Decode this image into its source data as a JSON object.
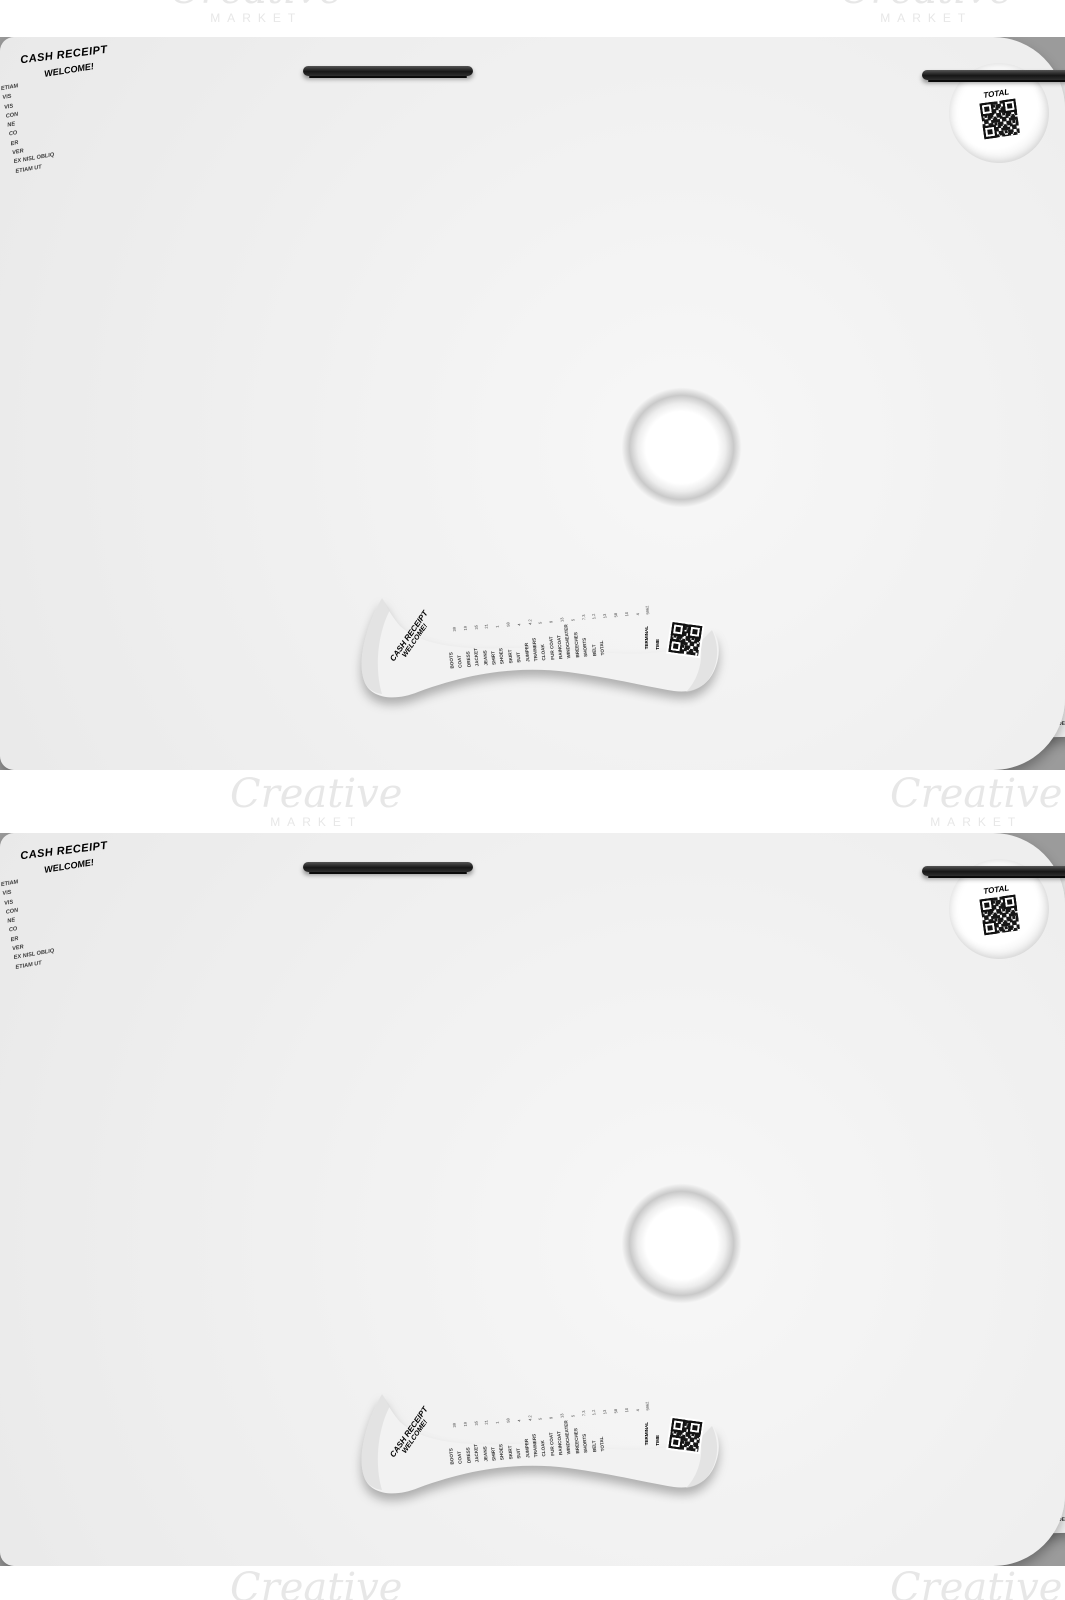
{
  "watermark": {
    "script": "Creative",
    "caps": "MARKET"
  },
  "main_town": {
    "title": "MAIN TOWN STORE 1.2",
    "addr1": "LOREM IPSUM DOLOR SIT AMET",
    "addr2": "545 66-54 00000 1-XXX-00XXX48",
    "date": "Monday 11/10/2024",
    "time": "09:45 PM",
    "merchant": "Merchant ID: John Doe 544z5 g",
    "items": [
      {
        "l": "Etiam utinam",
        "v": "$ 4.5"
      },
      {
        "l": "Vis ex",
        "v": "$ 7.2"
      },
      {
        "l": "Vis decore",
        "v": "$ 17"
      },
      {
        "l": "Consequuntur",
        "v": "$ 4.5"
      },
      {
        "l": "Ne mel natum",
        "v": "$ 6.5"
      },
      {
        "l": "Consul, eam",
        "v": "$ 11.2"
      },
      {
        "l": "Error alterum",
        "v": "$ 47"
      },
      {
        "l": "Verterem",
        "v": "$ 1.21"
      },
      {
        "l": "Ex nisl oblique",
        "v": "$ 9.7"
      }
    ],
    "subtotal_l": "SUB TOTAL",
    "subtotal_v": "$ 107.01",
    "transaction": "Transaction: 15XX2-4501",
    "footer": "WELCOME!"
  },
  "lorem_office": {
    "title": "LOREM OFFICE #4",
    "subtitle": "RECEIPT #46-7F",
    "addr1": "126 Road-Vida posidonium incorrupte",
    "addr2": "Promo Discount #165 S/T/C 48",
    "items": [
      {
        "l": "Lorem voluptua",
        "v": "$ 8"
      },
      {
        "l": "Nostro",
        "v": "$ 6"
      },
      {
        "l": "Cu ius altera",
        "v": "$ 7.1"
      },
      {
        "l": "Soluta laoreet",
        "v": "$ 5.2"
      },
      {
        "l": "Ea prompta",
        "v": "$ 2"
      },
      {
        "l": "Ei has congue",
        "v": "$ 2.1"
      },
      {
        "l": "Corrumpit",
        "v": "$ 4.2"
      },
      {
        "l": "Verterem",
        "v": "$ 7.5"
      },
      {
        "l": "Accusam gloriatur",
        "v": "$ 4.8"
      },
      {
        "l": "Modus insolens",
        "v": "$ 1"
      },
      {
        "l": "Antiopam indoctum",
        "v": "$ 1.1"
      },
      {
        "l": "Nostro",
        "v": "$ 9.2"
      },
      {
        "l": "Causae quaestio",
        "v": "$ 7.2"
      },
      {
        "l": "Aeterno perfecto",
        "v": "$ 4"
      },
      {
        "l": "Accommodare",
        "v": "$ 4"
      },
      {
        "l": "Abore phaedrum",
        "v": "$ 1.2"
      },
      {
        "l": "Dard malestatis",
        "v": "$ 8.1"
      },
      {
        "l": "Est dicam",
        "v": "$ 1"
      },
      {
        "l": "Utent imperdiet",
        "v": "$ 3"
      },
      {
        "l": "Deserunt nam",
        "v": "$ 1.1"
      },
      {
        "l": "Detracto",
        "v": "$ 7.2"
      }
    ],
    "pay_l": "You PAY",
    "pay_v": "$ 95",
    "terminal": "TERMINAL# 04",
    "date": "12.11.2022 13:01",
    "code": "XXX-X46"
  },
  "your_shop": {
    "title": "YOUR SHOP HERE",
    "addr": "FLOWER ST 45F LOREM CITY, 31431484 08067",
    "terminal": "TERMINAL A/7",
    "time": "8:40 PM",
    "items": [
      {
        "l": "Beer",
        "v": "$ 24"
      },
      {
        "l": "Vine",
        "v": "$ 75"
      },
      {
        "l": "Chicken meat",
        "v": "$ 23"
      },
      {
        "l": "Salmon",
        "v": "$ 5"
      },
      {
        "l": "Broccoli",
        "v": "$ 11"
      },
      {
        "l": "Leek",
        "v": "$ 5"
      },
      {
        "l": "Cranberry",
        "v": "$ 12"
      },
      {
        "l": "Cottage cheese",
        "v": "$ 23"
      },
      {
        "l": "Caramel",
        "v": "$ 8"
      },
      {
        "l": "Pumpkin pie",
        "v": "$ 13"
      }
    ],
    "subtotal_l": "SUB TOTAL",
    "subtotal_v": "$ 199",
    "footer": "THANK YOU FOR COMING!"
  },
  "d12": {
    "title": "RECEIPT",
    "number": "D#12",
    "order": "ORDER#43/5",
    "time": "23:11",
    "date": "TUE 31.10.2025",
    "manager": "MANAGER JANE DOE  #1012",
    "items": [
      {
        "l": "CLAW HAMMER",
        "v": "4.15"
      },
      {
        "l": "FLATHEAD SCREWDRIVER",
        "v": "7.2"
      },
      {
        "l": "PHILLIPS SCREWDRIVER",
        "v": "1.23"
      },
      {
        "l": "CRESCENT WRENCH",
        "v": "4.2"
      }
    ],
    "total_l": "YOUR TOTAL",
    "total_v": "16.78",
    "footer": "THANK YOU FOR VIZITING!"
  },
  "brand_shop": {
    "title": "BRAND SHOP",
    "subtitle": "CASH RECEIPT #181101",
    "cashier": "Cashier: 1X01 Card: 01***1X",
    "items": [
      {
        "l": "T-shirt",
        "v": "2.5"
      },
      {
        "l": "Waistcoat",
        "v": "1.4"
      },
      {
        "l": "Hoodie",
        "v": "5.4"
      },
      {
        "l": "Breeches",
        "v": "5.6"
      },
      {
        "l": "Sweat pants",
        "v": "8.7"
      },
      {
        "l": "Dress shirt",
        "v": "1.2"
      },
      {
        "l": "Dressing gown",
        "v": "7.1"
      },
      {
        "l": "Wrap dress",
        "v": "9.8"
      },
      {
        "l": "Slip dress",
        "v": "5.1"
      }
    ],
    "subtotal_l": "SUBTOTAL",
    "subtotal_v": "$46.8",
    "total_l": "TOTAL",
    "total_v": "$46.8",
    "footer": "THANK YOU FOR COMING!",
    "note": "Lorem ipsum dolor sit amet sed ut fugit solet anima"
  },
  "store_long": {
    "welcome": "WELCOME TO OUR STORE",
    "title": "RECEIPT",
    "addr": "Lorem ipsum dolor street X City",
    "merchant": "MERCHANT: JANE DOE 483#41",
    "items": [
      {
        "l": "INANI",
        "v": "45"
      },
      {
        "l": "LABORE",
        "v": "31"
      },
      {
        "l": "EAM ALIA",
        "v": "1"
      },
      {
        "l": "EA PROMPTA",
        "v": "21.1"
      },
      {
        "l": "NO VEL",
        "v": "5.5"
      },
      {
        "l": "ALIQUIP",
        "v": "4.1"
      },
      {
        "l": "APERIRI",
        "v": "5"
      },
      {
        "l": "SENSERIT ET",
        "v": "8"
      },
      {
        "l": "SOLUTA",
        "v": "11"
      },
      {
        "l": "LAOREET",
        "v": "8"
      },
      {
        "l": "DEFINIEBAS",
        "v": "12"
      },
      {
        "l": "IQ HIS",
        "v": "10.1"
      },
      {
        "l": "TE DUO DUEM",
        "v": "48"
      },
      {
        "l": "DELICATISSIMI",
        "v": "3.8"
      },
      {
        "l": "EA PROMPTA",
        "v": "1.8"
      },
      {
        "l": "DESERUNT EST",
        "v": "7.5"
      },
      {
        "l": "DICAM PROMPTA",
        "v": "2.2"
      },
      {
        "l": "OMITTANTUR AD VI",
        "v": "6.7"
      },
      {
        "l": "NO SEA EST",
        "v": "8"
      },
      {
        "l": "MAIESTATIS",
        "v": "7"
      },
      {
        "l": "INIMICUS NO HAS",
        "v": "4.8"
      },
      {
        "l": "QUI EX CAUSAE",
        "v": "9"
      },
      {
        "l": "QUAESTIO",
        "v": "1.5"
      },
      {
        "l": "SCRIPSERIT",
        "v": "6.2"
      },
      {
        "l": "DOMINO",
        "v": "1.7"
      },
      {
        "l": "IN VIRIS DENIQUE",
        "v": "7.1"
      },
      {
        "l": "PROBATUS HIS",
        "v": "8"
      },
      {
        "l": "DUO SIMUL ACCUSAM",
        "v": "11"
      },
      {
        "l": "SIT AN PRIMI",
        "v": "8"
      },
      {
        "l": "PERICULIS",
        "v": "7.12"
      },
      {
        "l": "PRI IUDICO PRAESEN",
        "v": "3.1"
      },
      {
        "l": "EX FERRI VIVENDUM",
        "v": "7.8"
      },
      {
        "l": "DEMOCRITUM UT PER",
        "v": "1.6"
      },
      {
        "l": "LOREM",
        "v": "5"
      },
      {
        "l": "LUPTUA",
        "v": "7.7"
      },
      {
        "l": "ADOLESCENS HAS",
        "v": "8.5"
      },
      {
        "l": "NE UT MEI DICTA",
        "v": "4.2"
      },
      {
        "l": "DEMOCRITUM",
        "v": "11"
      },
      {
        "l": "AD HAS FACILISI",
        "v": "5"
      },
      {
        "l": "ADIPISCI",
        "v": "8"
      },
      {
        "l": "PERSIUS AN",
        "v": "8.5"
      },
      {
        "l": "QUI VIDE",
        "v": "1.23"
      },
      {
        "l": "POSIDONIUM",
        "v": "10"
      },
      {
        "l": "INCORRUPTE",
        "v": "3.8"
      },
      {
        "l": "CUM TE",
        "v": "5.3"
      },
      {
        "l": "SCRIBENTUR",
        "v": "2"
      }
    ],
    "discount_l": "Discount",
    "discount_v": "25",
    "total_l": "PAY TOTAL",
    "total_v": "387,55",
    "time": "10:11 AM",
    "date": "FRI 12.11.2024",
    "card": "CARD XXXX-40XX-0S1X-XXXX",
    "phone": "PHONE 951(848)XX-78-XX215-XX",
    "copy": "CUSTOMER COPY",
    "footer": "THANK YOU FOR SHOPPING"
  },
  "restaurant": {
    "title": "RESTAURANT",
    "subtitle": "RECEIPT #2437",
    "code": "CODE 13 04 21 51158 212",
    "items": [
      {
        "l": "Bacon And Eggs",
        "q": "13x2",
        "v": "$26"
      },
      {
        "l": "Grill",
        "q": "12.4x1",
        "v": "$12.4"
      },
      {
        "l": "Hot Dog",
        "q": "10x3",
        "v": "$30"
      },
      {
        "l": "Spare Ribs",
        "q": "24.1x1",
        "v": "$24.1"
      },
      {
        "l": "Soup",
        "q": "17x2",
        "v": "$34"
      },
      {
        "l": "Beer",
        "q": "7.5x3",
        "v": "$22.5"
      }
    ],
    "total_l": "TOTAL",
    "total_v": "$149",
    "card": "CARD 0XX0 **** **** XX00",
    "terminal": "Terminal ID 153X*-F1",
    "footer": "THANKS, COME AGAIN!"
  },
  "coffee": {
    "title": "COFFEE HOUSE BRAND",
    "code": "*132-1610* - 045 *0111*-1612*045 *0111*",
    "items": [
      {
        "l": "COFFEE",
        "v": "1.2"
      },
      {
        "l": "VANILLA",
        "v": "4.5"
      },
      {
        "l": "CARBONATED WATER",
        "v": "8.1"
      },
      {
        "l": "HOT CHOCOLATE",
        "v": "8.1"
      },
      {
        "l": "SOFT DRINK",
        "v": "5.4"
      },
      {
        "l": "PANCAKE",
        "v": "1.2"
      },
      {
        "l": "GINGERBREAD",
        "v": "8.1"
      },
      {
        "l": "CINNAMON ROLL",
        "v": "7.2"
      },
      {
        "l": "CARROT CAKE",
        "v": "1.5"
      },
      {
        "l": "CHOCOLATE BAR",
        "v": "4.5"
      },
      {
        "l": "CANDY BAR",
        "v": "6.1"
      },
      {
        "l": "CINNAMON",
        "v": "7.8"
      }
    ],
    "discount_l": "DISCOUNT",
    "discount_v": "$17",
    "subtotal_l": "SUBTOTAL",
    "subtotal_v": "61.7",
    "total_l": "TOTAL",
    "total_v": "44.7",
    "stars": "* * *",
    "thanks": "THANK YOU"
  },
  "cash_left": {
    "title": "CASH RECEIPT",
    "terminal": "Terminal 7B Code 77***0121",
    "items": [
      {
        "l": "Rebum Posse",
        "v": "$ 2"
      },
      {
        "l": "Perfecto Cu Mel",
        "v": "$ 8"
      },
      {
        "l": "Verear",
        "v": "$ 4"
      },
      {
        "l": "Detraxit In Sit",
        "v": "$ 6"
      },
      {
        "l": "Ancillae Molestiae",
        "v": "$ 1"
      },
      {
        "l": "Ei has congue",
        "v": "$ 9"
      },
      {
        "l": "Vidisse Utroque",
        "v": "$ 7"
      },
      {
        "l": "Verterem",
        "v": "$ 3"
      },
      {
        "l": "Lorem Graecis",
        "v": "$ 2"
      },
      {
        "l": "Recteque",
        "v": "$ 8"
      }
    ],
    "subtotal_l": "Subtotal",
    "subtotal_v": "$50",
    "discount_l": "Discount",
    "discount_v": "10%",
    "total_l": "TOTAL",
    "total_v": "$45",
    "footer": "!!!  THANKS  !!!"
  },
  "cash_small": {
    "title": "CASH RECEIPT",
    "term": "TERM ID 1 505598 51 4 216 451 84",
    "adress_l": "Adress:",
    "adress_v": "Lorem ipsum dolor s",
    "manager_l": "Manager:",
    "manager_v": "J",
    "tax_l": "TAX",
    "total_l": "TOTAL",
    "time": "02:10 PM",
    "date": "11.12.2023",
    "code": "CODE135"
  },
  "curl": {
    "items": [
      {
        "l": "Causae",
        "v": ""
      },
      {
        "l": "Aeterno perfecto",
        "v": "$ 4"
      },
      {
        "l": "Accommodare",
        "v": "$ 1.2"
      },
      {
        "l": "Abore phaedrum",
        "v": "$ 6.1"
      },
      {
        "l": "Dard malestatis",
        "v": "$ 1"
      },
      {
        "l": "Est dicam",
        "v": "$ 3"
      },
      {
        "l": "Utent imperdiet",
        "v": "$ 1.1"
      },
      {
        "l": "Deserunt nam",
        "v": "$ 7.2"
      },
      {
        "l": "Detracto",
        "v": ""
      }
    ],
    "total_l": "TOTAL",
    "total_v": "$ 38.8",
    "welcome": "*  WELCOME  *"
  },
  "roll": {
    "title": "CASH RECEIPT",
    "welcome": "WELCOME!",
    "total": "TOTAL",
    "fragments": [
      "ETIAM",
      "VIS",
      "VIS",
      "CON",
      "NE",
      "CO",
      "ER",
      "VER",
      "EX NISL OBLIQ",
      "ETIAM UT"
    ]
  },
  "wavy": {
    "title": "CASH RECEIPT",
    "welcome": "WELCOME!",
    "items": [
      "BOOTS",
      "COAT",
      "DRESS",
      "JACKET",
      "JEANS",
      "SHIRT",
      "SHOES",
      "SKIRT",
      "SUIT",
      "JUMPER",
      "TRAINERS",
      "CLOAK",
      "FUR COAT",
      "RAINCOAT",
      "WINDCHEATER",
      "BREECHES",
      "SHORTS",
      "BELT",
      "TOTAL"
    ],
    "vals": [
      "39",
      "19",
      "35",
      "21",
      "1",
      "58",
      "4",
      "4.2",
      "5",
      "9",
      "13",
      "5",
      "7.3",
      "1.2",
      "13",
      "58",
      "10",
      "4",
      "5962"
    ],
    "terminal": "TERMINAL",
    "time": "TIME"
  }
}
